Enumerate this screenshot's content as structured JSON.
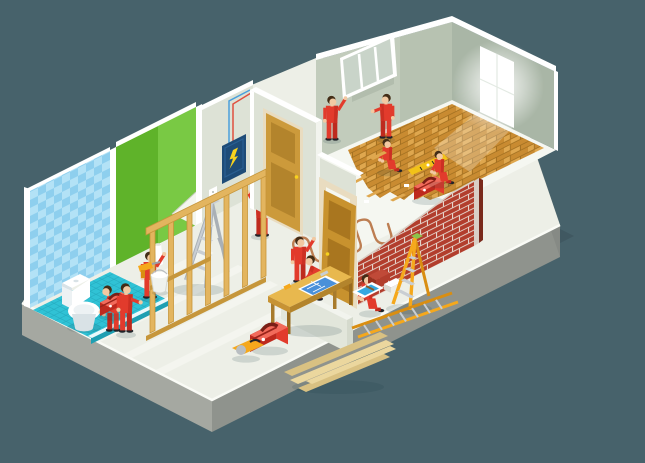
{
  "meta": {
    "title": "Isometric home repair illustration: workers in red overalls renovating an apartment cutaway",
    "canvas": {
      "width": 645,
      "height": 463
    }
  },
  "palette": {
    "bg": "#47626B",
    "shadow": "#3D545C",
    "shadowSoft": "#1E3A42",
    "slabL": "#A5A8A1",
    "slabR": "#8F938D",
    "slabS": "#868A85",
    "floor": "#EDEFE7",
    "stripe": "#FAFBF6",
    "farFloor": "#F5F7F1",
    "wallGray": "#DDE2D6",
    "cap": "#FFFFFF",
    "capDim": "#F2F4EE",
    "kneeFace": "#E2E6DB",
    "farWallL": "#C2CCBC",
    "farWallLDk": "#B7C2B1",
    "farWallR": "#A9B6A6",
    "opening": "#B2BDAD",
    "glass": "#C9D4C9",
    "tileA": "#8ECFEE",
    "tileB": "#B3E2F6",
    "bathFloor": "#30C2D5",
    "bathGrid": "#23A9BD",
    "bathSkirt": "#1E9FB2",
    "toiletW": "#FFFFFF",
    "toiletSh": "#D9E2E6",
    "toiletIn": "#EDF2F4",
    "green": "#5FB32A",
    "greenLt": "#79C944",
    "peel": "#F4F6EF",
    "red": "#E23B2C",
    "redDk": "#BE2A1E",
    "skin": "#F2C9A2",
    "hair": "#432D17",
    "shoe": "#20242A",
    "woodStud": "#E3B55F",
    "woodStudDk": "#C6963B",
    "doorTan": "#CC9A3B",
    "doorTanDk": "#B3842C",
    "doorFrame": "#E9DCC0",
    "leafTan": "#C8922E",
    "leafTanDk": "#A9761F",
    "parqA": "#C98B31",
    "parqB": "#DFA74E",
    "parqDk": "#9E6D1F",
    "plank": "#EBD79E",
    "plankDk": "#D9C182",
    "brick": "#B23E2D",
    "brickDk": "#7A2A1C",
    "brickEnd": "#D9CFC6",
    "mortar": "#E9DFD6",
    "yellow": "#F5A81C",
    "yellowDk": "#D98E12",
    "alu": "#C9CED3",
    "aluDk": "#A9B0B6",
    "ladderTop": "#8BC34A",
    "navy": "#1E4C78",
    "navyLt": "#2A5F92",
    "bolt": "#F7D21E",
    "wireR": "#E0503F",
    "wireB": "#4BA0DC",
    "pipe": "#BD7E52",
    "print": "#4A90D9",
    "level": "#F2C218",
    "tray": "#35A8E0",
    "toolboxLight": "#F26B5B"
  },
  "scene": {
    "background": "#47626B",
    "workers": {
      "count": 11,
      "uniform_color": "#E23B2C"
    },
    "elements": [
      {
        "name": "floor-slab",
        "label": "isometric concrete floor slab"
      },
      {
        "name": "bathroom",
        "label": "bathroom with blue tiled wall and turquoise floor"
      },
      {
        "name": "toilet",
        "label": "white toilet being installed"
      },
      {
        "name": "worker-toilet",
        "label": "plumber bending over toilet"
      },
      {
        "name": "toolbox-bathroom",
        "label": "red toolbox"
      },
      {
        "name": "green-wall",
        "label": "green wallpapered wall with peeled corner"
      },
      {
        "name": "worker-wallpaper",
        "label": "worker hanging green wallpaper"
      },
      {
        "name": "stepladder-aluminum",
        "label": "aluminum stepladder"
      },
      {
        "name": "gray-wall",
        "label": "gray wall with electrical panel"
      },
      {
        "name": "electrical-panel",
        "label": "navy fuse box with lightning bolt"
      },
      {
        "name": "wires",
        "label": "red and blue wires"
      },
      {
        "name": "outlet",
        "label": "wall outlet"
      },
      {
        "name": "worker-electrician",
        "label": "electrician at fuse box"
      },
      {
        "name": "stud-framing",
        "label": "wooden stud partition frame"
      },
      {
        "name": "worker-driller",
        "label": "worker with yellow drill"
      },
      {
        "name": "bucket",
        "label": "white bucket"
      },
      {
        "name": "workbench",
        "label": "wooden workbench with blueprint"
      },
      {
        "name": "worker-carpenter",
        "label": "carpenter at workbench"
      },
      {
        "name": "toolbox-center",
        "label": "red toolbox"
      },
      {
        "name": "circular-saw",
        "label": "yellow circular saw"
      },
      {
        "name": "plank-stack",
        "label": "stack of wooden boards"
      },
      {
        "name": "partition-door",
        "label": "closed tan interior door"
      },
      {
        "name": "door-installation",
        "label": "two workers hanging a wooden door"
      },
      {
        "name": "knee-wall",
        "label": "low white cutaway wall"
      },
      {
        "name": "brick-wall",
        "label": "unfinished red brick wall"
      },
      {
        "name": "stepladder-yellow",
        "label": "yellow stepladder"
      },
      {
        "name": "ladder-flat",
        "label": "yellow ladder lying on floor"
      },
      {
        "name": "brick-stack",
        "label": "stacked bricks and blocks"
      },
      {
        "name": "paint-tray",
        "label": "tray with blue paint"
      },
      {
        "name": "far-room",
        "label": "room with parquet being laid"
      },
      {
        "name": "floor-heating-pipes",
        "label": "serpentine underfloor heating pipe"
      },
      {
        "name": "parquet-floor",
        "label": "partially laid parquet"
      },
      {
        "name": "workers-parquet",
        "label": "two kneeling floor layers"
      },
      {
        "name": "spirit-level",
        "label": "yellow spirit level"
      },
      {
        "name": "toolbox-far-room",
        "label": "red toolbox"
      },
      {
        "name": "window-installation",
        "label": "two workers carrying white window frame"
      },
      {
        "name": "glowing-window",
        "label": "bright window on right wall"
      }
    ]
  }
}
